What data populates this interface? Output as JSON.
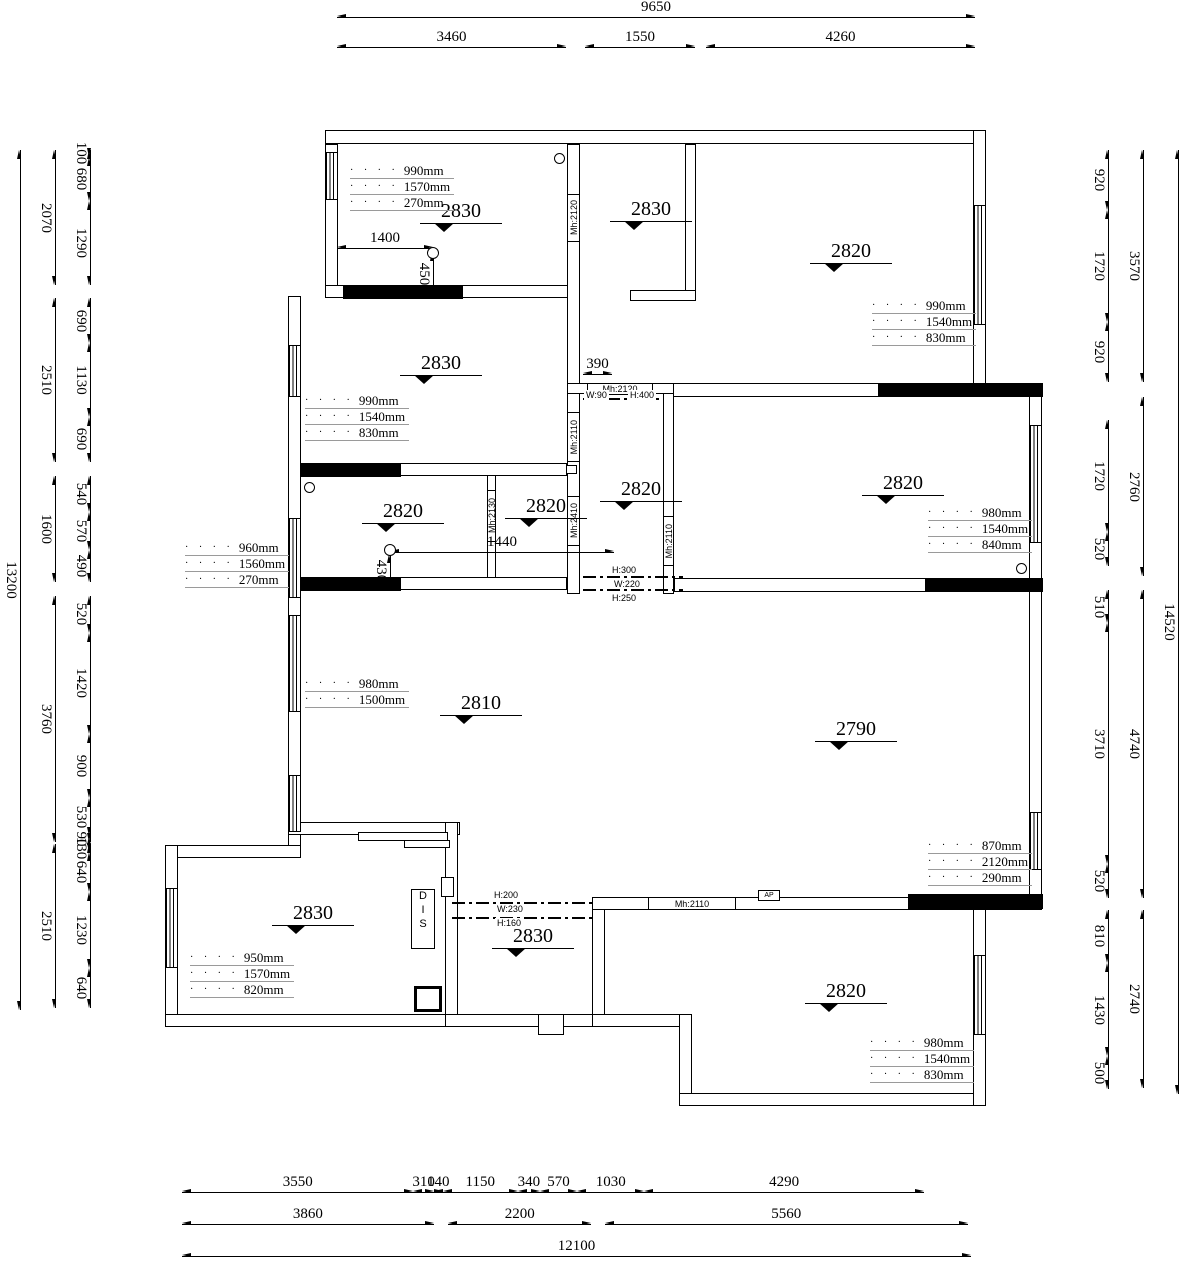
{
  "drawing": {
    "top_dims": {
      "total": "9650",
      "segments": [
        "3460",
        "1550",
        "4260"
      ]
    },
    "bottom_dims": {
      "row1": [
        "3550",
        "310",
        "140",
        "1150",
        "340",
        "570",
        "1030",
        "4290"
      ],
      "row2": [
        "3860",
        "2200",
        "5560"
      ],
      "total": "12100"
    },
    "left_dims": {
      "total": "13200",
      "groups": [
        {
          "sum": "2070",
          "parts": [
            "100",
            "680",
            "1290"
          ]
        },
        {
          "sum": "2510",
          "parts": [
            "690",
            "1130",
            "690"
          ]
        },
        {
          "sum": "1600",
          "parts": [
            "540",
            "570",
            "490"
          ]
        },
        {
          "sum": "3760",
          "parts": [
            "520",
            "1420",
            "900",
            "530",
            "90"
          ]
        },
        {
          "sum": "2510",
          "parts": [
            "130",
            "640",
            "1230",
            "640"
          ]
        }
      ]
    },
    "right_dims": {
      "total": "14520",
      "groups": [
        {
          "sum": "3570",
          "parts": [
            "920",
            "1720",
            "920"
          ]
        },
        {
          "sum": "2760",
          "parts": [
            "1720",
            "520"
          ]
        },
        {
          "sum": "4740",
          "parts": [
            "510",
            "3710",
            "520"
          ]
        },
        {
          "sum": "2740",
          "parts": [
            "810",
            "1430",
            "500"
          ]
        }
      ]
    },
    "ceiling_heights": [
      "2830",
      "2830",
      "2820",
      "2830",
      "2820",
      "2820",
      "2820",
      "2820",
      "2810",
      "2790",
      "2830",
      "2830",
      "2820"
    ],
    "window_annotations": [
      [
        "990mm",
        "1570mm",
        "270mm"
      ],
      [
        "990mm",
        "1540mm",
        "830mm"
      ],
      [
        "990mm",
        "1540mm",
        "830mm"
      ],
      [
        "960mm",
        "1560mm",
        "270mm"
      ],
      [
        "980mm",
        "1540mm",
        "840mm"
      ],
      [
        "980mm",
        "1500mm"
      ],
      [
        "870mm",
        "2120mm",
        "290mm"
      ],
      [
        "950mm",
        "1570mm",
        "820mm"
      ],
      [
        "980mm",
        "1540mm",
        "830mm"
      ]
    ],
    "inline_dims": [
      "1400",
      "450",
      "1440",
      "430",
      "390"
    ],
    "door_labels": [
      "Mh:2120",
      "Mh:2120",
      "Mh:2110",
      "Mh:2410",
      "Mh:2130",
      "Mh:2110",
      "Mh:2110"
    ],
    "beam_labels": {
      "corridor_top": [
        "W:90",
        "H:400"
      ],
      "corridor_bottom": [
        "H:300",
        "W:220",
        "H:250"
      ],
      "mid": [
        "H:200",
        "W:230",
        "H:160"
      ]
    },
    "misc_labels": {
      "dis": "DIS",
      "ap": "AP"
    }
  }
}
